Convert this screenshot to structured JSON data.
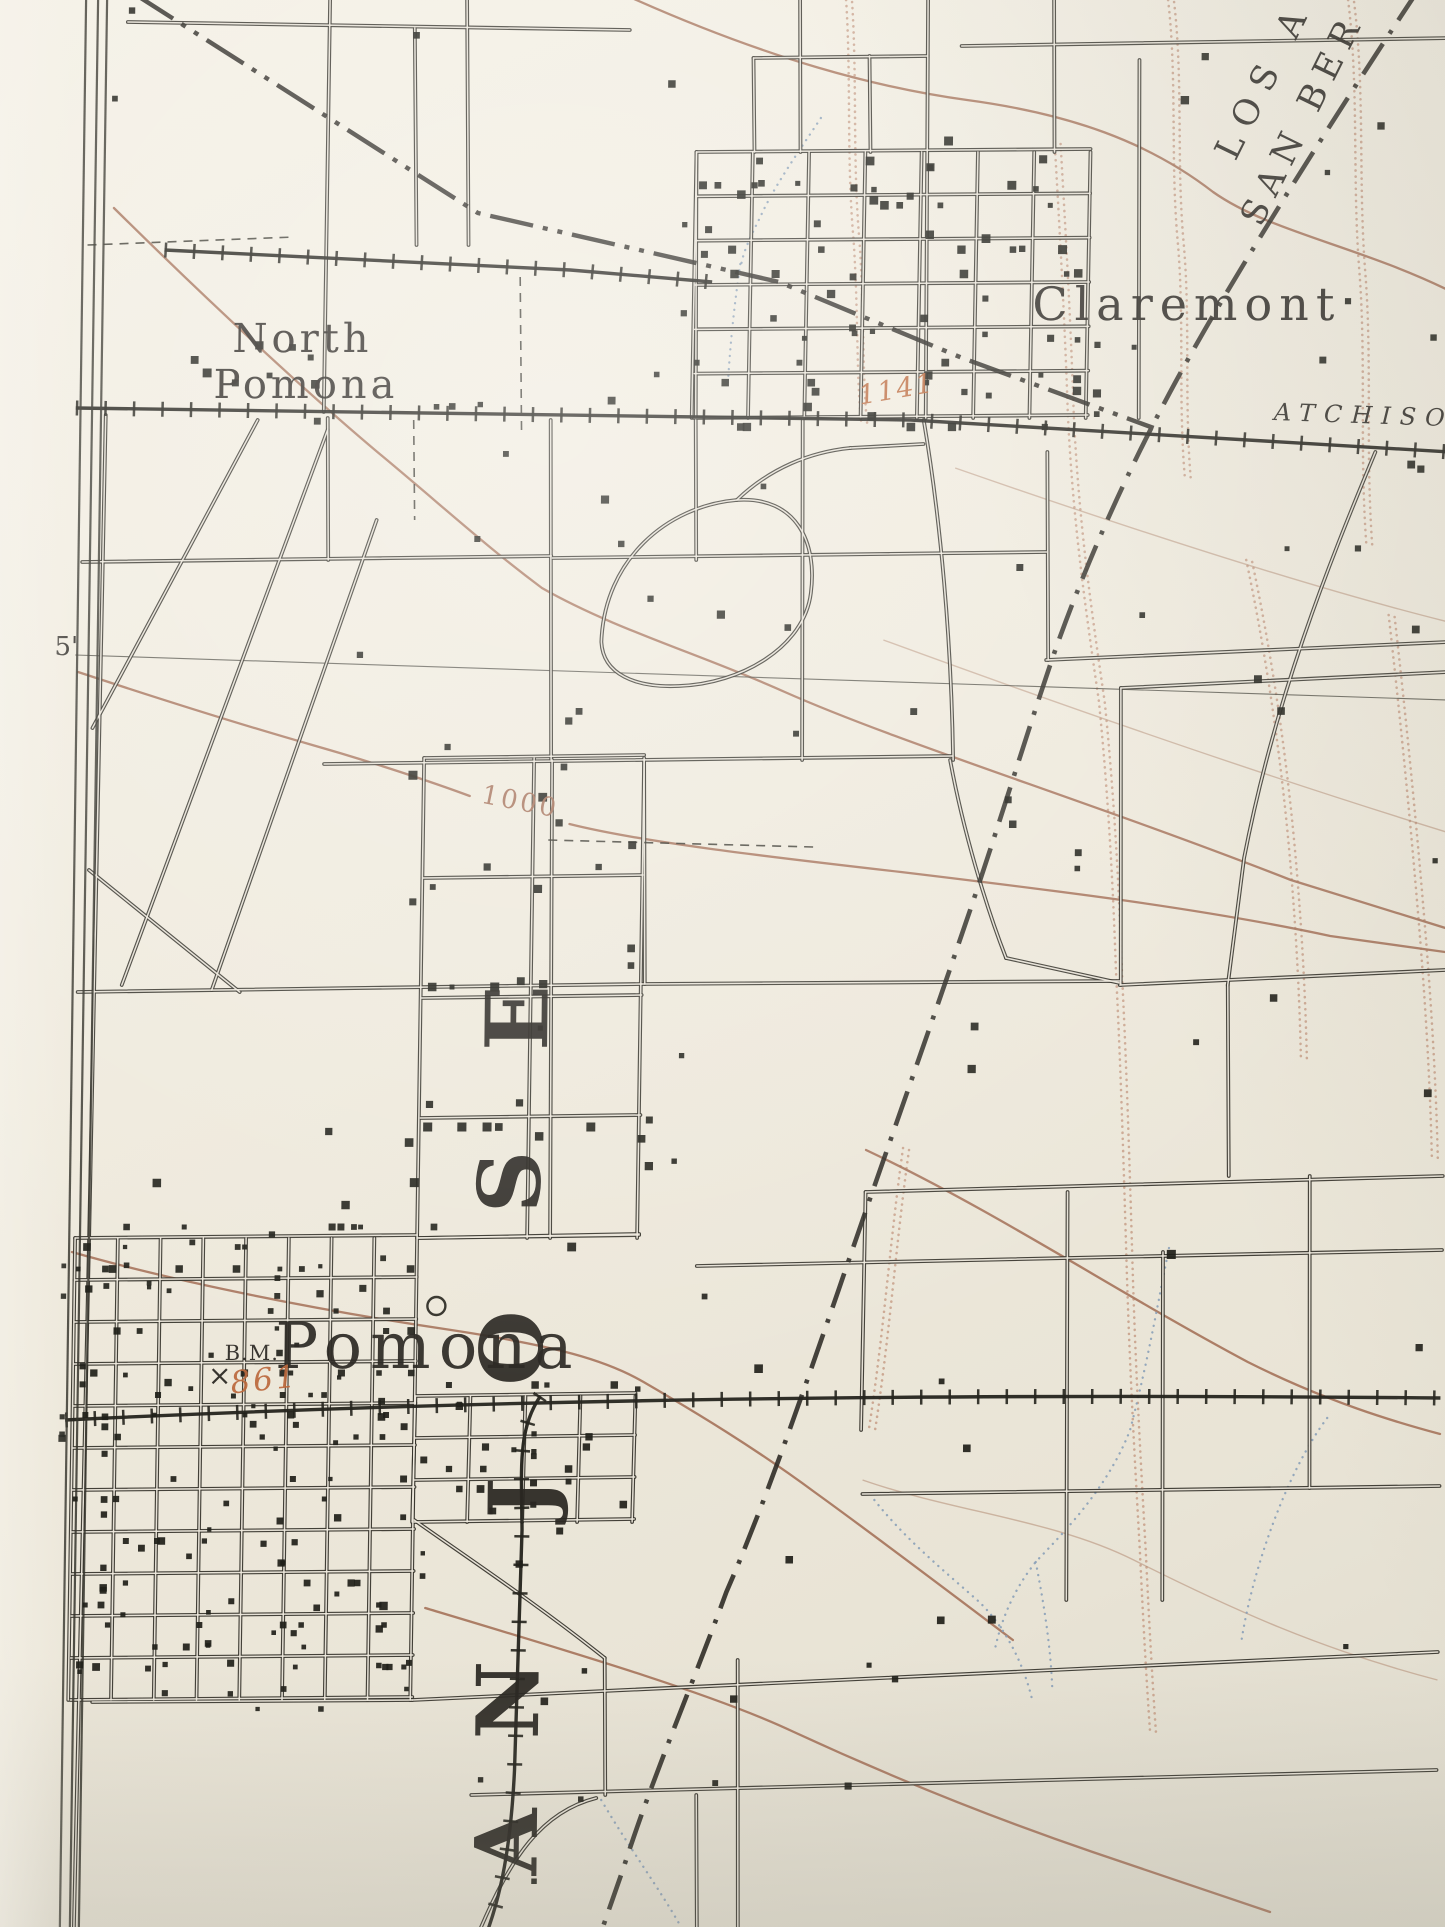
{
  "map": {
    "title": "USGS-style topographic map photo — Pomona / Claremont area",
    "width": 1445,
    "height": 1927,
    "colors": {
      "paper": "#efeade",
      "ink": "#34322a",
      "building": "#201f19",
      "rail": "#25241d",
      "boundary": "#2a2822",
      "contour": "#a5725a",
      "contour_faint": "#b28a72",
      "wash": "#c79e87",
      "stream": "#8aa0b8",
      "red": "#bc6a3e",
      "label": "#2a2722"
    }
  },
  "labels": [
    {
      "name": "label-north-pomona-line1",
      "text": "North",
      "x": 296,
      "y": 352,
      "size": 40,
      "ls": 4
    },
    {
      "name": "label-north-pomona-line2",
      "text": "Pomona",
      "x": 300,
      "y": 398,
      "size": 40,
      "ls": 4
    },
    {
      "name": "label-claremont",
      "text": "Claremont",
      "x": 1180,
      "y": 320,
      "size": 46,
      "ls": 7
    },
    {
      "name": "label-pomona",
      "text": "Pomona",
      "x": 432,
      "y": 1368,
      "size": 64,
      "ls": 8
    },
    {
      "name": "label-benchmark",
      "text": "B.M.",
      "x": 256,
      "y": 1360,
      "size": 21,
      "ls": 1
    },
    {
      "name": "label-benchmark-cross",
      "text": "×",
      "x": 224,
      "y": 1385,
      "size": 28
    },
    {
      "name": "label-elevation-861",
      "text": "861",
      "x": 270,
      "y": 1390,
      "size": 31,
      "rot": -6,
      "italic": true,
      "color": "red",
      "ls": 3
    },
    {
      "name": "label-elevation-1141",
      "text": "1141",
      "x": 892,
      "y": 398,
      "size": 27,
      "rot": -10,
      "italic": true,
      "color": "red",
      "ls": 2
    },
    {
      "name": "label-contour-1000",
      "text": "1000",
      "x": 517,
      "y": 810,
      "size": 26,
      "rot": 11,
      "color": "contour",
      "ls": 3
    },
    {
      "name": "label-graticule-5min",
      "text": "5'",
      "x": 63,
      "y": 655,
      "size": 26
    },
    {
      "name": "label-railroad-atchison",
      "text": "ATCHISO",
      "x": 1268,
      "y": 420,
      "size": 24,
      "rot": 2,
      "italic": true,
      "ls": 9,
      "anchor": "start"
    },
    {
      "name": "label-county-los-angeles",
      "text": "LOS A",
      "x": 1227,
      "y": 162,
      "size": 35,
      "rot": -64,
      "ls": 12,
      "anchor": "start"
    },
    {
      "name": "label-county-san-bernardino",
      "text": "SAN BER",
      "x": 1253,
      "y": 228,
      "size": 35,
      "rot": -64,
      "ls": 9,
      "anchor": "start"
    }
  ],
  "big_letters": {
    "word": "SAN JOSE (rancho name, reads bottom-to-top)",
    "size": 86,
    "rot": -90,
    "letters": [
      {
        "name": "rancho-letter-E",
        "text": "E",
        "x": 548,
        "y": 1018
      },
      {
        "name": "rancho-letter-S2",
        "text": "S",
        "x": 542,
        "y": 1182
      },
      {
        "name": "rancho-letter-O",
        "text": "O",
        "x": 546,
        "y": 1348
      },
      {
        "name": "rancho-letter-J",
        "text": "J",
        "x": 556,
        "y": 1498
      },
      {
        "name": "rancho-letter-N",
        "text": "N",
        "x": 546,
        "y": 1700
      },
      {
        "name": "rancho-letter-A",
        "text": "A",
        "x": 546,
        "y": 1842
      },
      {
        "name": "rancho-letter-S1",
        "text": "S",
        "x": 552,
        "y": 1975
      }
    ]
  },
  "features": {
    "graticule": [
      "M72,655 L1445,700"
    ],
    "boundaries": {
      "county": "M1408,-10 C1330,110 1255,230 1198,330 C1140,432 1090,540 1052,650 C1022,740 995,835 958,945 C920,1060 880,1175 842,1290 C805,1400 770,1505 733,1592 C700,1685 660,1780 633,1868 L612,1930",
      "rancho": "M126,-5 L470,213 L772,282 L956,358 L1148,428"
    },
    "railroads": [
      {
        "name": "railroad-atsf-main",
        "path": "M70,408 L905,420 L1445,452"
      },
      {
        "name": "railroad-sp-main",
        "path": "M70,1420 C400,1404 820,1392 1445,1398"
      },
      {
        "name": "railroad-south-branch",
        "path": "M545,1396 C522,1430 527,1470 528,1530 L523,1770 C520,1850 510,1895 498,1930"
      },
      {
        "name": "railroad-spur",
        "path": "M157,250 L563,270 L705,282"
      }
    ],
    "dashed_thin": [
      "M80,245 L287,237",
      "M513,277 L516,433",
      "M547,840 L812,847",
      "M408,420 L410,520"
    ],
    "border_lines": [
      "M88,0 L80,1927",
      "M97,0 L89,1927",
      "M76,0 L70,1927"
    ],
    "roads": [
      "M118,22 L620,30",
      "M320,0 L318,412",
      "M457,0 L461,245",
      "M405,28 L409,245",
      "M688,152 L690,418",
      "M790,0 L792,152",
      "M918,0 L920,418",
      "M1044,0 L1046,152",
      "M952,46 L1445,38",
      "M1130,60 L1133,418",
      "M744,58 L918,56",
      "M744,58 L746,152",
      "M860,56 L862,152",
      "M100,415 L92,1238",
      "M322,418 L324,560",
      "M545,420 L549,760",
      "M550,760 L553,1238",
      "M797,418 L800,760",
      "M918,420 C936,520 948,640 951,760",
      "M1042,452 L1045,660",
      "M78,562 L547,556",
      "M322,764 L950,756",
      "M78,992 L642,984",
      "M642,984 L1120,981",
      "M642,760 L645,984",
      "M548,558 L1042,552",
      "M690,420 L692,560",
      "M252,420 L90,728",
      "M322,430 L122,985",
      "M372,520 L212,990",
      "M88,870 L240,992",
      "M598,642 C600,560 662,506 732,500 C792,496 813,543 807,593 C801,647 738,684 676,686 C632,688 600,674 598,642",
      "M732,500 C765,468 805,452 845,448",
      "M845,448 L918,444",
      "M1370,452 C1322,570 1272,700 1243,858 L1228,985",
      "M1043,660 L1445,642",
      "M1118,688 L1121,985",
      "M1118,688 L1445,672",
      "M948,760 C962,832 986,908 1006,958",
      "M1006,958 L1120,983",
      "M1120,985 L1445,970",
      "M868,1192 L1445,1176",
      "M700,1266 L1445,1250",
      "M868,1192 L866,1430",
      "M1070,1192 L1073,1600",
      "M1166,1252 L1169,1600",
      "M1312,1176 L1315,1488",
      "M868,1494 L1445,1486",
      "M1228,985 L1231,1176",
      "M420,1238 L642,1234",
      "M420,1520 C480,1562 545,1605 612,1658",
      "M100,1702 L420,1700",
      "M420,1700 L1445,1652",
      "M480,1795 L1445,1770",
      "M612,1658 L614,1795",
      "M745,1660 L748,1930",
      "M490,1930 C520,1858 550,1812 605,1798",
      "M705,1795 L707,1930",
      "M92,1238 L84,1930"
    ],
    "grids": [
      {
        "name": "claremont-grid",
        "x0": 688,
        "y0": 152,
        "x1": 1082,
        "y1": 418,
        "cols": 7,
        "rows": 6
      },
      {
        "name": "pomona-grid",
        "x0": 78,
        "y0": 1238,
        "x1": 420,
        "y1": 1700,
        "cols": 8,
        "rows": 11
      },
      {
        "name": "pomona-east-grid",
        "x0": 420,
        "y0": 1396,
        "x1": 640,
        "y1": 1522,
        "cols": 4,
        "rows": 3
      },
      {
        "name": "central-parcels",
        "x0": 422,
        "y0": 758,
        "x1": 642,
        "y1": 1238,
        "cols": 2,
        "rows": 4
      }
    ],
    "building_clusters": [
      {
        "name": "claremont-buildings",
        "gi": 0,
        "count": 72,
        "size": 7,
        "seed": 11
      },
      {
        "name": "pomona-buildings",
        "gi": 1,
        "count": 150,
        "size": 6,
        "seed": 7
      },
      {
        "name": "pomona-east-buildings",
        "gi": 2,
        "count": 26,
        "size": 6,
        "seed": 5
      },
      {
        "name": "north-pomona-buildings",
        "x": 150,
        "y": 328,
        "w": 190,
        "h": 80,
        "count": 7,
        "size": 7,
        "seed": 3
      },
      {
        "name": "farm-buildings",
        "x": 95,
        "y": 5,
        "w": 1340,
        "h": 1880,
        "count": 95,
        "size": 7,
        "seed": 13
      },
      {
        "name": "central-parcel-buildings",
        "gi": 3,
        "count": 28,
        "size": 7,
        "seed": 17
      }
    ],
    "contours": [
      "M106,208 C200,300 300,392 372,452 C440,508 480,545 538,588 C612,630 700,655 782,692 C900,744 1090,802 1290,880 C1380,908 1420,920 1445,928",
      "M75,672 C160,700 240,725 310,745 C370,762 430,782 468,796 M568,824 C640,842 760,856 900,872 C1050,890 1200,908 1330,936 L1445,952",
      "M615,-5 C760,60 870,88 958,100 C1062,114 1140,142 1205,192 C1262,232 1352,246 1445,292",
      "M868,1150 C1000,1212 1120,1292 1252,1362 C1332,1402 1400,1422 1445,1434",
      "M432,1608 C572,1650 722,1694 802,1732 C902,1778 1002,1818 1102,1852 C1180,1878 1240,1898 1280,1912",
      "M75,1252 C180,1282 320,1310 455,1330 C560,1346 610,1360 648,1382 C700,1412 760,1448 820,1492 C880,1535 940,1580 1020,1640"
    ],
    "contours_faint": [
      "M880,640 C1050,702 1250,772 1445,832",
      "M950,468 C1100,520 1300,586 1445,622",
      "M868,1480 C960,1512 1060,1520 1140,1560 C1240,1610 1330,1650 1445,1680"
    ],
    "washes": [
      "M1158,0 C1168,80 1162,160 1170,240 C1178,320 1172,400 1180,480",
      "M1338,0 C1350,90 1344,180 1352,270 C1360,360 1354,450 1362,545",
      "M1046,142 C1052,230 1058,320 1062,412 C1068,520 1082,610 1096,700 C1106,790 1112,880 1116,970 C1122,1070 1126,1170 1130,1270 C1134,1370 1140,1460 1146,1550 C1150,1620 1154,1680 1158,1730",
      "M836,0 C842,80 838,160 846,240 C852,320 850,380 856,425",
      "M1242,560 C1262,650 1278,750 1288,850 C1296,930 1300,1000 1302,1060",
      "M1385,615 C1398,720 1410,830 1420,940 C1428,1030 1432,1100 1434,1160",
      "M905,1148 C893,1240 888,1330 874,1428"
    ],
    "streams": [
      "M812,118 C790,152 766,186 752,218 C742,238 736,252 734,264",
      "M733,264 C728,300 724,340 722,380",
      "M1172,1248 C1162,1300 1152,1362 1135,1430 C1112,1492 1062,1540 1042,1562 C1020,1590 1008,1620 1002,1650",
      "M1042,1562 C1052,1610 1058,1650 1060,1690",
      "M1332,1418 C1293,1470 1258,1570 1248,1645",
      "M880,1500 C912,1540 952,1572 986,1602 C1010,1625 1030,1660 1040,1700",
      "M610,1800 C640,1850 670,1890 690,1925"
    ],
    "circle_symbol": {
      "x": 440,
      "y": 1306,
      "r": 9
    }
  }
}
